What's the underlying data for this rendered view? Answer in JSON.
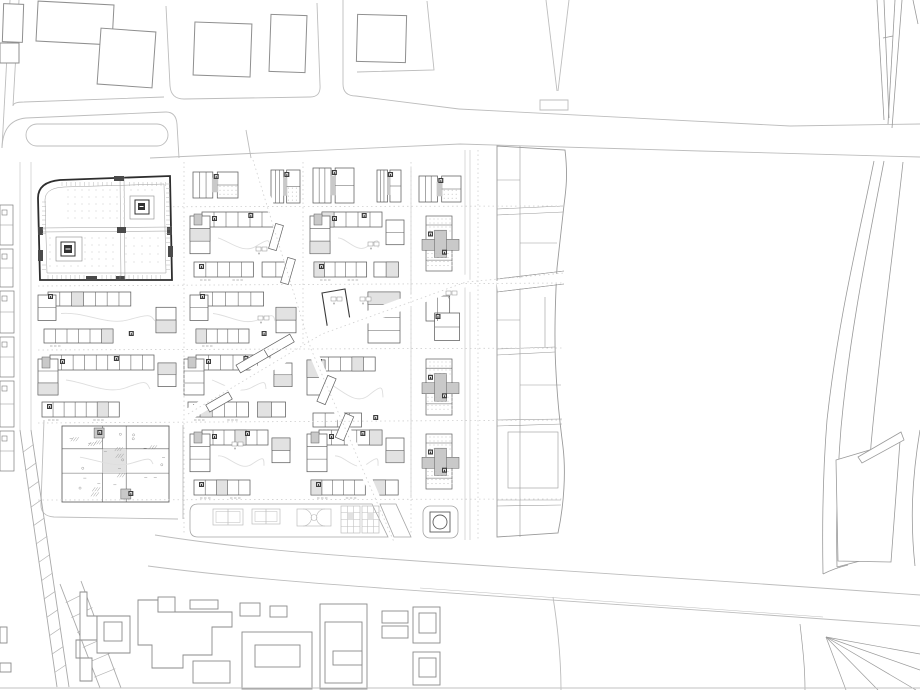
{
  "title": "urban-masterplan-site-plan",
  "canvas": {
    "w": 920,
    "h": 690
  },
  "colors": {
    "bg": "#ffffff",
    "road": "#bdbdbd",
    "casing": "#c9c9c9",
    "context": "#8f8f8f",
    "bld": "#5f5f5f",
    "bldDark": "#2e2e2e",
    "core": "#3c3c3c",
    "grayFill": "#c9c9c9",
    "lightFill": "#e2e2e2",
    "dots": "#c0c0c0",
    "courtyard": "#dedede",
    "court": "#bdbdbd",
    "hatch": "#9a9a9a",
    "dotted": "#cfcfcf",
    "baseline": "#c2c2c2"
  },
  "roads": {
    "paths": [
      {
        "d": "M10,0 L2,148"
      },
      {
        "d": "M19,0 L13,106 Q13,102 24,102 L164,97"
      },
      {
        "d": "M2,148 Q3,120 26,118 L166,112"
      },
      {
        "d": "M166,112 Q176,112 177,124 L179,158"
      },
      {
        "d": "M166,6 L170,86 Q171,99 184,99 L310,97 Q321,97 320,85 L317,3"
      },
      {
        "d": "M343,0 L343,84 Q343,96 356,96 L459,109"
      },
      {
        "d": "M427,1 L434,70 L357,72"
      },
      {
        "d": "M459,109 L790,126 L920,124"
      },
      {
        "d": "M150,158 L460,144 L700,151 L920,157"
      },
      {
        "d": "M251,158 L246,130"
      },
      {
        "d": "M546,0 L557,91"
      },
      {
        "d": "M569,0 L558,91"
      },
      {
        "d": "M540,100 L568,100 L568,110 L540,110 Z"
      },
      {
        "d": "M44,420 L41,503 Q40,516 54,517 L178,519"
      },
      {
        "d": "M183,425 L183,519"
      },
      {
        "d": "M553,597 C559,635 561,662 561,690"
      }
    ],
    "casing": [
      {
        "d": "M411,168 L411,498"
      },
      {
        "d": "M465,150 L465,540"
      },
      {
        "d": "M470,150 L470,540"
      },
      {
        "d": "M20,162 L20,430"
      },
      {
        "d": "M31,162 L31,430"
      }
    ],
    "island": {
      "x": 26,
      "y": 124,
      "w": 142,
      "h": 22,
      "r": 11
    },
    "dotted": [
      "M38,207 L564,206",
      "M38,286 L564,283",
      "M38,350 L564,348",
      "M38,423 L564,420",
      "M38,500 L564,499",
      "M184,162 L184,535",
      "M303,162 L303,345",
      "M411,162 L411,535",
      "M478,150 L478,540",
      "M253,160 L311,349",
      "M188,414 L322,334 L466,282 L564,273",
      "M311,349 L394,542"
    ]
  },
  "context_top": {
    "buildings": [
      {
        "x": 3,
        "y": 4,
        "w": 20,
        "h": 38,
        "rot": 2
      },
      {
        "x": 0,
        "y": 43,
        "w": 19,
        "h": 20,
        "rot": 0
      },
      {
        "x": 37,
        "y": 3,
        "w": 76,
        "h": 40,
        "rot": 3
      },
      {
        "x": 99,
        "y": 30,
        "w": 55,
        "h": 56,
        "rot": 4
      },
      {
        "x": 194,
        "y": 23,
        "w": 57,
        "h": 53,
        "rot": 2
      },
      {
        "x": 270,
        "y": 15,
        "w": 36,
        "h": 57,
        "rot": 2
      },
      {
        "x": 357,
        "y": 15,
        "w": 49,
        "h": 47,
        "rot": 1.5
      }
    ]
  },
  "left_strip": {
    "cells": [
      {
        "x": 0,
        "y": 205,
        "w": 13,
        "h": 40
      },
      {
        "x": 0,
        "y": 249,
        "w": 13,
        "h": 38
      },
      {
        "x": 0,
        "y": 291,
        "w": 14,
        "h": 42
      },
      {
        "x": 0,
        "y": 337,
        "w": 14,
        "h": 40
      },
      {
        "x": 0,
        "y": 381,
        "w": 14,
        "h": 46
      },
      {
        "x": 0,
        "y": 431,
        "w": 14,
        "h": 40
      }
    ]
  },
  "focus": {
    "outline": "M60,180 L170,176 L172,280 L40,280 L38,198 Q38,182 60,180 Z",
    "innerRing": "M64,187 L164,184 L166,273 L47,273 L45,200 Q45,188 64,187 Z",
    "walls": [
      "M40,228 L172,227",
      "M40,232 L172,231",
      "M120,177 L121,280",
      "M124,177 L125,280"
    ],
    "dotRegions": [
      {
        "x": 68,
        "y": 190,
        "w": 90,
        "h": 32,
        "st": 7
      },
      {
        "x": 50,
        "y": 238,
        "w": 66,
        "h": 32,
        "st": 7
      },
      {
        "x": 126,
        "y": 238,
        "w": 38,
        "h": 30,
        "st": 8
      }
    ],
    "cores": [
      {
        "ox": 130,
        "oy": 196,
        "ow": 24,
        "oh": 23,
        "mx": 135,
        "my": 200,
        "ms": 14,
        "ix": 138,
        "iy": 203,
        "is": 7
      },
      {
        "ox": 56,
        "oy": 237,
        "ow": 26,
        "oh": 24,
        "mx": 61,
        "my": 242,
        "ms": 14,
        "ix": 64,
        "iy": 245,
        "is": 8
      }
    ],
    "stubs": [
      {
        "x": 114,
        "y": 176,
        "w": 10,
        "h": 5
      },
      {
        "x": 168,
        "y": 246,
        "w": 5,
        "h": 11
      },
      {
        "x": 86,
        "y": 276,
        "w": 11,
        "h": 5
      },
      {
        "x": 38,
        "y": 250,
        "w": 5,
        "h": 11
      },
      {
        "x": 116,
        "y": 276,
        "w": 9,
        "h": 5
      },
      {
        "x": 117,
        "y": 227,
        "w": 9,
        "h": 6
      },
      {
        "x": 38,
        "y": 227,
        "w": 5,
        "h": 8
      },
      {
        "x": 167,
        "y": 227,
        "w": 5,
        "h": 8
      }
    ],
    "tickEdges": [
      {
        "x1": 62,
        "y1": 182,
        "x2": 166,
        "y2": 180,
        "dir": "v",
        "len": 4,
        "st": 4.5,
        "skip": [
          112,
          128
        ]
      },
      {
        "x1": 42,
        "y1": 202,
        "x2": 42,
        "y2": 272,
        "dir": "h",
        "len": 4,
        "st": 4.5,
        "skip": [
          236,
          262
        ]
      },
      {
        "x1": 166,
        "y1": 184,
        "x2": 166,
        "y2": 270,
        "dir": "h",
        "len": 4,
        "st": 4.5,
        "skip": [
          244,
          258
        ]
      },
      {
        "x1": 48,
        "y1": 275,
        "x2": 164,
        "y2": 275,
        "dir": "v",
        "len": 4,
        "st": 4.5,
        "skip": [
          84,
          100
        ]
      }
    ]
  },
  "blocks": [
    {
      "x": 193,
      "y": 172,
      "w": 45,
      "h": 26,
      "v": "small",
      "s": 1
    },
    {
      "x": 271,
      "y": 170,
      "w": 29,
      "h": 33,
      "v": "small",
      "s": 2
    },
    {
      "x": 313,
      "y": 168,
      "w": 41,
      "h": 35,
      "v": "small",
      "s": 3
    },
    {
      "x": 377,
      "y": 170,
      "w": 24,
      "h": 32,
      "v": "small",
      "s": 4
    },
    {
      "x": 419,
      "y": 176,
      "w": 42,
      "h": 26,
      "v": "small",
      "s": 5
    },
    {
      "x": 190,
      "y": 212,
      "w": 106,
      "h": 65,
      "v": "peri",
      "s": 6
    },
    {
      "x": 310,
      "y": 212,
      "w": 94,
      "h": 65,
      "v": "peri",
      "s": 7
    },
    {
      "x": 418,
      "y": 212,
      "w": 45,
      "h": 65,
      "v": "cross",
      "s": 8
    },
    {
      "x": 190,
      "y": 292,
      "w": 106,
      "h": 51,
      "v": "peri2",
      "s": 9
    },
    {
      "x": 362,
      "y": 292,
      "w": 42,
      "h": 51,
      "v": "slab",
      "s": 10
    },
    {
      "x": 420,
      "y": 294,
      "w": 43,
      "h": 50,
      "v": "smalll",
      "s": 11
    },
    {
      "x": 38,
      "y": 292,
      "w": 138,
      "h": 51,
      "v": "peri2",
      "s": 20
    },
    {
      "x": 38,
      "y": 355,
      "w": 138,
      "h": 62,
      "v": "peri",
      "s": 12
    },
    {
      "x": 184,
      "y": 355,
      "w": 108,
      "h": 62,
      "v": "peri",
      "s": 13
    },
    {
      "x": 307,
      "y": 357,
      "w": 97,
      "h": 70,
      "v": "peri2",
      "s": 14
    },
    {
      "x": 418,
      "y": 355,
      "w": 45,
      "h": 66,
      "v": "cross",
      "s": 15
    },
    {
      "x": 62,
      "y": 426,
      "w": 107,
      "h": 76,
      "v": "dense",
      "s": 16
    },
    {
      "x": 190,
      "y": 430,
      "w": 100,
      "h": 65,
      "v": "peri",
      "s": 17
    },
    {
      "x": 307,
      "y": 430,
      "w": 97,
      "h": 65,
      "v": "peri",
      "s": 18
    },
    {
      "x": 418,
      "y": 430,
      "w": 45,
      "h": 65,
      "v": "cross",
      "s": 19
    }
  ],
  "parallelogram": "M322,293 L345,289 L351,326 L328,331 Z",
  "diag": {
    "swaths": [
      {
        "d": "M252,158 C284,240 300,295 312,352",
        "w": 8
      },
      {
        "d": "M186,416 L322,334 L468,280",
        "w": 12
      },
      {
        "d": "M468,286 L564,278",
        "w": 12
      },
      {
        "d": "M312,350 L396,545",
        "w": 9
      }
    ],
    "slabs": [
      {
        "x": 236,
        "y": 356,
        "w": 34,
        "h": 9,
        "rot": -30
      },
      {
        "x": 264,
        "y": 341,
        "w": 30,
        "h": 9,
        "rot": -30
      },
      {
        "x": 206,
        "y": 398,
        "w": 26,
        "h": 8,
        "rot": -30
      },
      {
        "x": 322,
        "y": 376,
        "w": 9,
        "h": 28,
        "rot": 23
      },
      {
        "x": 340,
        "y": 414,
        "w": 9,
        "h": 26,
        "rot": 23
      },
      {
        "x": 272,
        "y": 224,
        "w": 8,
        "h": 26,
        "rot": 16
      },
      {
        "x": 284,
        "y": 258,
        "w": 8,
        "h": 26,
        "rot": 16
      }
    ]
  },
  "plots": {
    "outline": "M497,146 L565,150 C568,175 566,190 564,205 L557,268 C555,305 554,340 556,372 C558,412 561,430 563,447 C566,472 564,505 558,533 L497,537 Z",
    "inner": [
      "M520,146 L520,537",
      "M497,209 L563,206",
      "M497,215 L563,212",
      "M497,349 L555,347",
      "M497,355 L555,352",
      "M497,420 L562,419",
      "M497,426 L562,424",
      "M497,500 L561,500",
      "M497,506 L561,505",
      "M497,279 L564,271",
      "M497,292 L564,284",
      "M497,180 L520,180",
      "M520,243 L557,243",
      "M545,297 L545,347",
      "M497,320 L520,320",
      "M520,385 L561,385"
    ],
    "innerRect": {
      "x": 508,
      "y": 432,
      "w": 50,
      "h": 56
    }
  },
  "sports": {
    "band": "M198,504 L372,504 L388,537 L198,537 Q190,537 190,529 L190,512 Q190,504 198,504 Z",
    "fragment": "M380,504 L396,504 L411,537 L394,537 Z",
    "tennis": [
      {
        "x": 213,
        "y": 509,
        "w": 30,
        "h": 16
      },
      {
        "x": 252,
        "y": 509,
        "w": 28,
        "h": 15
      }
    ],
    "basket": {
      "x": 297,
      "y": 509,
      "w": 34,
      "h": 17
    },
    "gardens": [
      {
        "x": 341,
        "y": 506,
        "w": 19,
        "h": 27
      },
      {
        "x": 362,
        "y": 506,
        "w": 17,
        "h": 27
      }
    ],
    "monument": {
      "plot": {
        "x": 423,
        "y": 506,
        "w": 35,
        "h": 32,
        "r": 7
      },
      "square": {
        "x": 430,
        "y": 512,
        "w": 20,
        "h": 20
      },
      "circle": {
        "cx": 440,
        "cy": 522,
        "r": 7
      }
    }
  },
  "highway": {
    "lines": [
      "M877,0 L884,120",
      "M884,0 L889,118",
      "M895,0 L888,124",
      "M902,0 L892,128",
      "M883,38 L893,36",
      "M913,0 L918,24",
      "M874,161 C858,240 838,320 827,420 C823,470 822,520 823,574",
      "M884,161 C868,245 850,330 841,428 C837,478 836,525 837,567",
      "M903,162 C893,255 880,345 871,445 C868,490 867,525 868,562",
      "M920,430 C912,478 910,520 915,566",
      "M823,574 Q835,568 848,565",
      "M837,567 L864,560",
      "M843,470 C849,505 847,535 846,558"
    ],
    "shapes": [
      "M836,460 L900,441 L891,562 L838,561 Z",
      "M858,457 L901,432 L904,440 L862,463 Z"
    ]
  },
  "d3road": {
    "lines": [
      "M155,535 C300,558 430,560 920,595",
      "M148,566 C300,586 430,590 920,626",
      "M420,588 L823,617"
    ]
  },
  "rail": {
    "bands": [
      {
        "ax1": 20,
        "ay1": 430,
        "ax2": 57,
        "ay2": 687,
        "bx1": 31,
        "by1": 430,
        "bx2": 69,
        "by2": 687,
        "n": 14
      },
      {
        "ax1": 60,
        "ay1": 584,
        "ax2": 100,
        "ay2": 688,
        "bx1": 81,
        "by1": 581,
        "bx2": 121,
        "by2": 688,
        "n": 7
      }
    ],
    "stems": [
      "M20,430 L57,687",
      "M31,430 L69,687",
      "M60,584 L100,688",
      "M81,581 L121,688"
    ]
  },
  "fan": {
    "lines": [
      "M826,637 L920,654",
      "M826,637 L920,670",
      "M826,637 L916,690",
      "M826,637 L878,690",
      "M826,637 L846,690",
      "M800,624 C803,650 805,668 805,690"
    ]
  },
  "bottom": {
    "polys": [
      "M80,592 L87,592 L87,616 L97,616 L97,640 L76,640 L76,658 L92,658 L92,681 L80,681 Z",
      "M97,616 L130,616 L130,653 L97,653 Z",
      "M138,600 L158,600 L158,612 L232,612 L232,627 L212,627 L212,655 L183,655 L183,668 L152,668 L152,645 L138,645 Z"
    ],
    "rects": [
      {
        "x": 104,
        "y": 622,
        "w": 18,
        "h": 19
      },
      {
        "x": 158,
        "y": 597,
        "w": 17,
        "h": 15
      },
      {
        "x": 190,
        "y": 600,
        "w": 28,
        "h": 9
      },
      {
        "x": 240,
        "y": 603,
        "w": 20,
        "h": 13
      },
      {
        "x": 270,
        "y": 606,
        "w": 17,
        "h": 11
      },
      {
        "x": 193,
        "y": 661,
        "w": 37,
        "h": 22
      },
      {
        "x": 242,
        "y": 632,
        "w": 70,
        "h": 57
      },
      {
        "x": 255,
        "y": 645,
        "w": 45,
        "h": 22
      },
      {
        "x": 320,
        "y": 604,
        "w": 47,
        "h": 85
      },
      {
        "x": 325,
        "y": 622,
        "w": 37,
        "h": 61
      },
      {
        "x": 333,
        "y": 651,
        "w": 29,
        "h": 14
      },
      {
        "x": 382,
        "y": 611,
        "w": 26,
        "h": 12
      },
      {
        "x": 382,
        "y": 626,
        "w": 26,
        "h": 12
      },
      {
        "x": 413,
        "y": 607,
        "w": 27,
        "h": 36
      },
      {
        "x": 419,
        "y": 613,
        "w": 17,
        "h": 20
      },
      {
        "x": 413,
        "y": 652,
        "w": 27,
        "h": 33
      },
      {
        "x": 419,
        "y": 658,
        "w": 17,
        "h": 19
      },
      {
        "x": 0,
        "y": 627,
        "w": 7,
        "h": 16
      },
      {
        "x": 0,
        "y": 663,
        "w": 11,
        "h": 9
      }
    ]
  },
  "glyphs": [
    [
      256,
      247
    ],
    [
      368,
      242
    ],
    [
      331,
      297
    ],
    [
      360,
      297
    ],
    [
      446,
      291
    ],
    [
      232,
      442
    ],
    [
      258,
      316
    ]
  ],
  "baselineY": 688
}
